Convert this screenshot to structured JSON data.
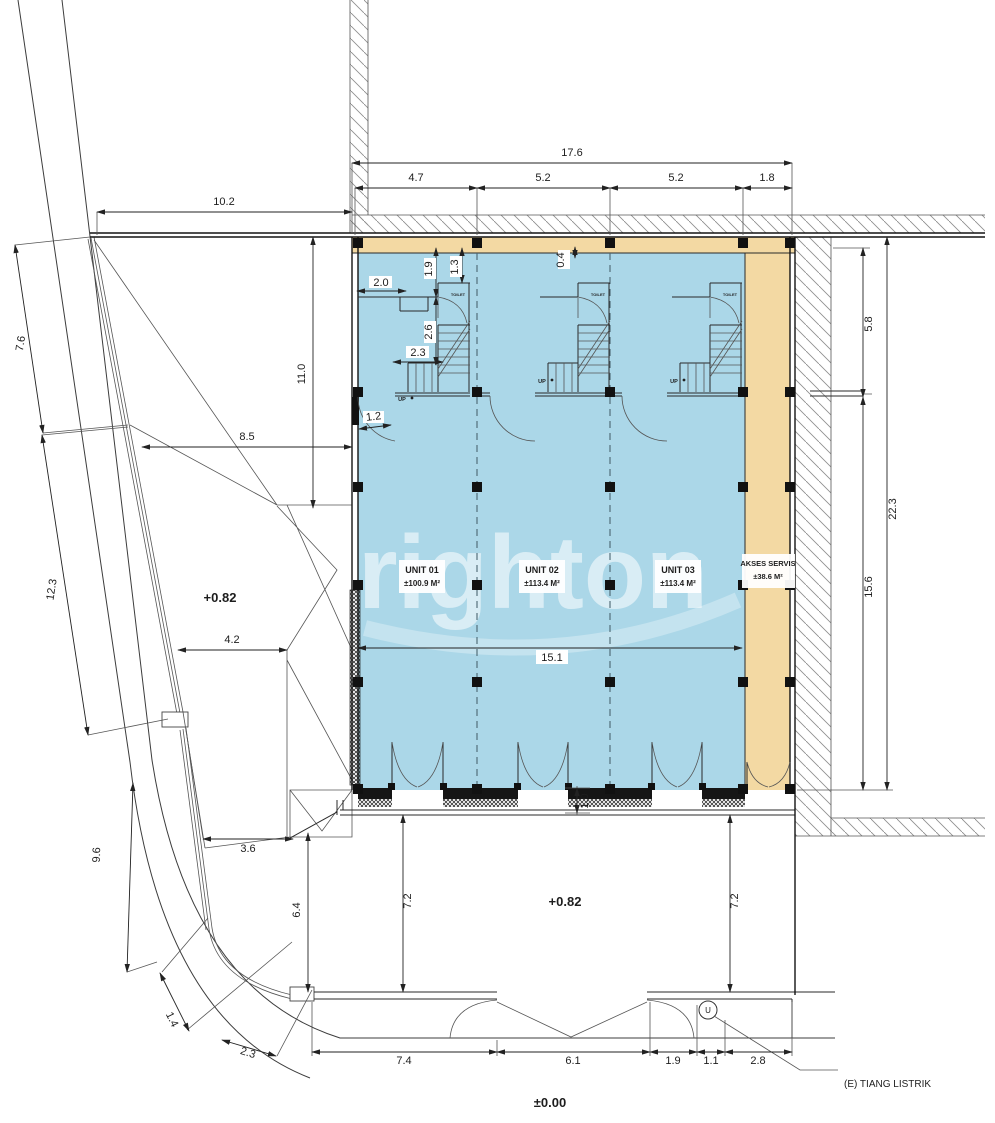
{
  "plan": {
    "watermark": "righton",
    "levels": {
      "site": "+0.82",
      "terrace": "+0.82",
      "street": "±0.00"
    },
    "units": [
      {
        "name": "UNIT 01",
        "area": "±100.9 M²"
      },
      {
        "name": "UNIT 02",
        "area": "±113.4 M²"
      },
      {
        "name": "UNIT 03",
        "area": "±113.4 M²"
      }
    ],
    "service_area": {
      "name": "AKSES SERVIS",
      "area": "±38.6 M²"
    },
    "labels": {
      "up": "UP",
      "toilet": "TOILET",
      "electric_pole": "(E) TIANG LISTRIK",
      "pole_symbol": "U"
    },
    "dimensions": {
      "top": {
        "overall": "17.6",
        "bays": [
          "4.7",
          "5.2",
          "5.2",
          "1.8"
        ],
        "site_front": "10.2"
      },
      "left": {
        "road_upper": "7.6",
        "side_setback": "11.0",
        "front_setback": "8.5",
        "road_mid": "12.3",
        "gap": "4.2",
        "road_lower": "9.6",
        "corner_short": "3.6",
        "corner_depth": "6.4",
        "curb_a": "1.4",
        "curb_b": "2.3"
      },
      "right": {
        "upper": "5.8",
        "overall": "22.3",
        "lower": "15.6"
      },
      "interior": {
        "hall_width": "2.0",
        "stair_a": "1.9",
        "stair_b": "1.3",
        "stair_c": "2.6",
        "stair_d": "2.3",
        "door": "1.2",
        "wall": "0.4",
        "shop_width": "15.1",
        "gap": "1.0"
      },
      "front": {
        "left_depth": "7.2",
        "right_depth": "7.2",
        "b_74": "7.4",
        "b_61": "6.1",
        "b_19": "1.9",
        "b_11": "1.1",
        "b_28": "2.8"
      }
    },
    "colors": {
      "unit_fill": "#abd7e8",
      "service_fill": "#f3d9a3"
    }
  }
}
